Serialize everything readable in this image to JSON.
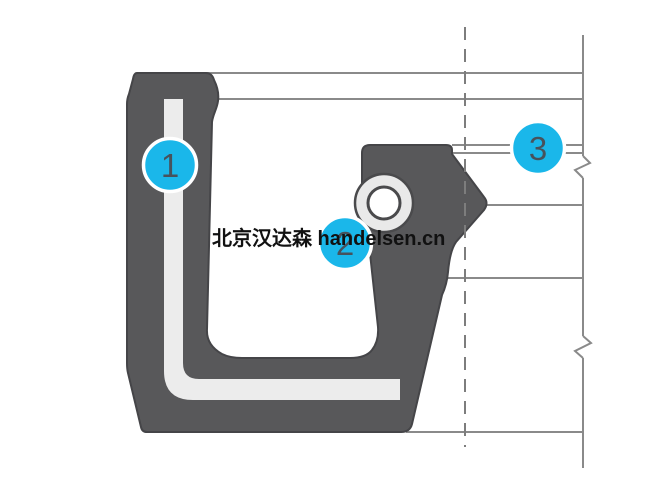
{
  "diagram": {
    "kind": "seal-cross-section",
    "watermark": {
      "text": "北京汉达森 handelsen.cn"
    },
    "callouts": [
      {
        "label": "1"
      },
      {
        "label": "2"
      },
      {
        "label": "3"
      }
    ]
  },
  "colors": {
    "background": "#ffffff",
    "body_fill": "#58585a",
    "body_outline": "#454548",
    "insert_fill": "#ececec",
    "spring_ring_fill": "#e9e9e9",
    "spring_inner_fill": "#ffffff",
    "spring_outline": "#4a4a4c",
    "ref_line": "#8a8a8a",
    "centerline": "#7d7d7d",
    "callout_fill": "#1ab7ea",
    "callout_ring": "#ffffff",
    "callout_text": "#47525c",
    "watermark_text": "#111111"
  }
}
